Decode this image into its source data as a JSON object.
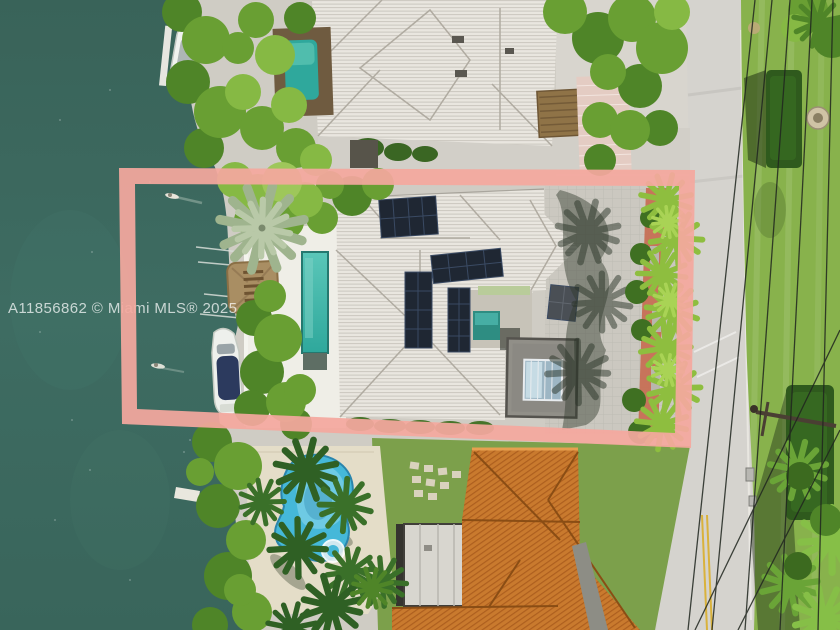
{
  "watermark": {
    "text": "A11856862 © Miami MLS® 2025"
  },
  "highlight": {
    "box_color": "#f4a89e"
  },
  "palette": {
    "water": "#3d6b61",
    "water_deep": "#38655b",
    "water_light": "#44766b",
    "roof_white": "#e9e6df",
    "roof_ridge": "#b0aba1",
    "solar_panel": "#1f2733",
    "solar_grid": "#3a4a63",
    "lap_pool": "#2fa89c",
    "lap_pool_light": "#5ac6b8",
    "pool_blue": "#45b8d9",
    "pool_blue_light": "#8fd9ec",
    "deck_cream": "#e4ddc8",
    "deck_white": "#efeee7",
    "driveway_gray": "#cbc8c0",
    "road_gray": "#d5d3ce",
    "grass_green": "#88b24c",
    "grass_dark": "#6f9c3f",
    "tree_dark": "#3c6a1f",
    "tree_mid": "#4f8528",
    "tree_bright": "#699f33",
    "tree_light": "#86b944",
    "palm_sunlit": "#8ebe3f",
    "orange_roof": "#c97a2e",
    "orange_ridge": "#8a4d14",
    "tiki_thatch": "#a98e63",
    "boat_cover_navy": "#2c3a5e",
    "paver_red": "#c76d52",
    "paver_pink": "#e4ccc3",
    "cube_gray": "#918f88",
    "skylight_glass": "#9db6c4",
    "yellow_line": "#d9b23c"
  }
}
